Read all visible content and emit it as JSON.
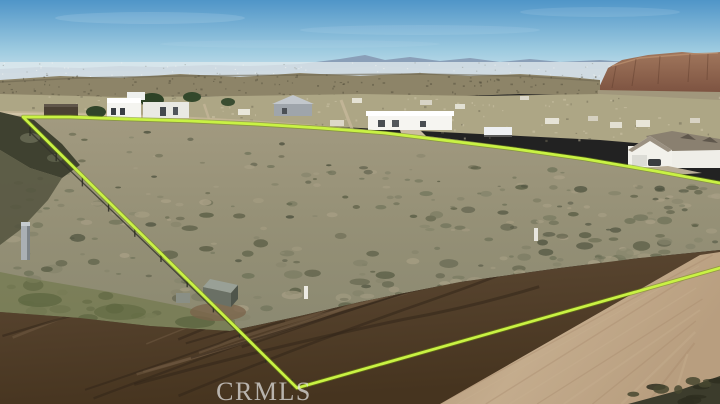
{
  "image": {
    "type": "aerial-drone-photograph",
    "subject": "vacant desert land parcel (real-estate listing photo) with lot boundary highlighted",
    "setting": "high-desert valley with scattered rural homes, distant mountain range and red-rock mesa"
  },
  "watermark": {
    "text": "CRMLS",
    "position": "bottom-center-left"
  },
  "lot_boundary": {
    "color": "#c9f244",
    "style": "bright chartreuse outline following dirt road and fence line",
    "points": [
      [
        720,
        183
      ],
      [
        655,
        171
      ],
      [
        585,
        159
      ],
      [
        515,
        149
      ],
      [
        450,
        141
      ],
      [
        385,
        133
      ],
      [
        320,
        128
      ],
      [
        255,
        124
      ],
      [
        190,
        121
      ],
      [
        125,
        119
      ],
      [
        70,
        117
      ],
      [
        23,
        117
      ],
      [
        297,
        388
      ],
      [
        720,
        268
      ]
    ]
  },
  "colors": {
    "boundary": "#c9f244",
    "watermark": "#e4e4e4",
    "sky_top": "#4f95c8",
    "sky_horizon": "#e2edf2",
    "mountains": "#8699b3",
    "mesa": "#96634a",
    "bluffs": "#8d8468",
    "scrub_light": "#9b947a",
    "scrub_dark": "#5c5f47",
    "grass_strip": "#6e7648",
    "dirt_dark": "#4a3826",
    "dirt_light": "#6f5942",
    "road": "#bba183",
    "house_white": "#f2f1eb"
  },
  "scene": {
    "elements": [
      {
        "name": "sky",
        "description": "clear blue sky with thin wispy haze"
      },
      {
        "name": "distant-mountain-range",
        "description": "blue-gray mountains across the horizon"
      },
      {
        "name": "red-rock-mesa",
        "description": "reddish-brown rocky mesa on the far right horizon"
      },
      {
        "name": "distant-valley",
        "description": "hazy valley floor with sparse development"
      },
      {
        "name": "desert-bluffs",
        "description": "olive-tan eroded bluff band in the middle distance"
      },
      {
        "name": "modern-white-house-complex",
        "description": "flat-roofed white buildings upper left"
      },
      {
        "name": "gray-gable-house",
        "description": "small gray house with gabled roof, upper middle-left"
      },
      {
        "name": "white-ranch-house",
        "description": "long single-story white house top center"
      },
      {
        "name": "semi-trailer",
        "description": "white box trailer parked near center"
      },
      {
        "name": "large-white-house",
        "description": "white house with brown shingle roof and dormers, right edge"
      },
      {
        "name": "vacant-lot-scrubland",
        "description": "desert scrub and sage brush inside the outlined parcel"
      },
      {
        "name": "chain-link-fence",
        "description": "fence running along the left diagonal boundary"
      },
      {
        "name": "utility-pedestal",
        "description": "gray utility box on the left edge of the lot"
      },
      {
        "name": "storage-shed",
        "description": "small gray shed near the graded dirt"
      },
      {
        "name": "survey-posts",
        "description": "white pipe markers inside the lot"
      },
      {
        "name": "graded-dirt",
        "description": "dark churned dirt with tire tracks across the foreground"
      },
      {
        "name": "dirt-road",
        "description": "wide light-tan graded dirt road in the lower right"
      },
      {
        "name": "lot-boundary-overlay",
        "description": "chartreuse polygon marking the parcel, clipped at right edge"
      },
      {
        "name": "crmls-watermark",
        "description": "translucent CRMLS logotype at bottom"
      }
    ]
  }
}
